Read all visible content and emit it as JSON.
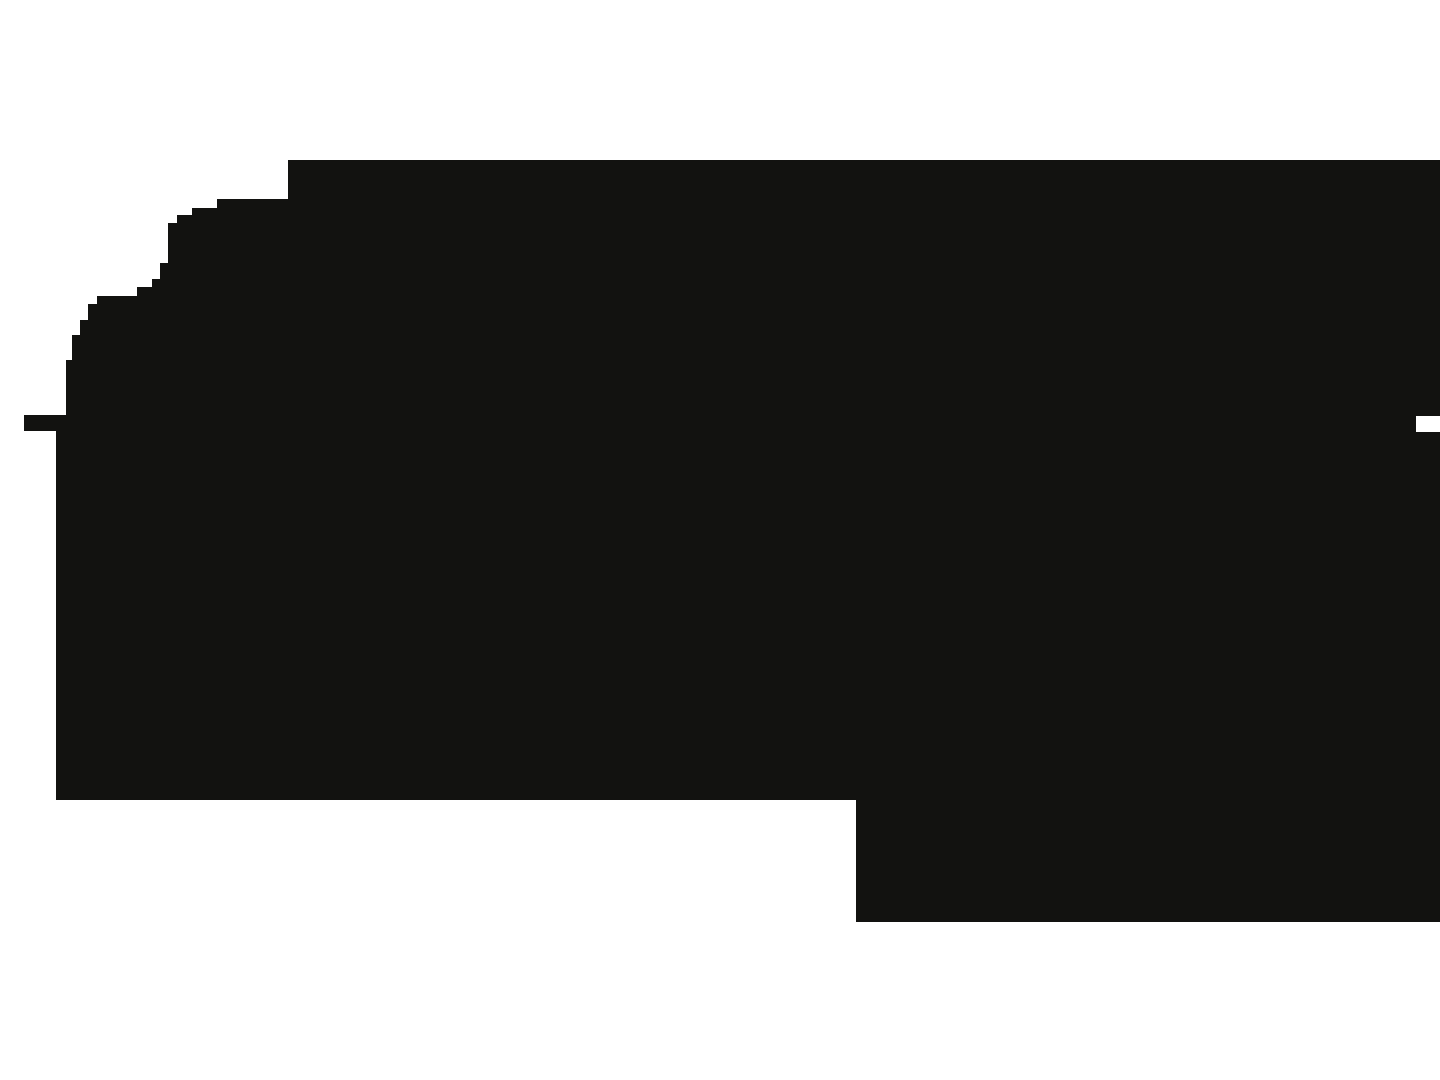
{
  "canvas": {
    "width": 1440,
    "height": 1080,
    "background_color": "#ffffff"
  },
  "silhouette": {
    "fill_color": "#121210",
    "points": [
      [
        288,
        160
      ],
      [
        1440,
        160
      ],
      [
        1440,
        416
      ],
      [
        1416,
        416
      ],
      [
        1416,
        432
      ],
      [
        1440,
        432
      ],
      [
        1440,
        922
      ],
      [
        856,
        922
      ],
      [
        856,
        800
      ],
      [
        56,
        800
      ],
      [
        56,
        431
      ],
      [
        24,
        431
      ],
      [
        24,
        415
      ],
      [
        66,
        415
      ],
      [
        66,
        360
      ],
      [
        72,
        360
      ],
      [
        72,
        335
      ],
      [
        80,
        335
      ],
      [
        80,
        320
      ],
      [
        88,
        320
      ],
      [
        88,
        304
      ],
      [
        97,
        304
      ],
      [
        97,
        296
      ],
      [
        137,
        296
      ],
      [
        137,
        287
      ],
      [
        152,
        287
      ],
      [
        152,
        279
      ],
      [
        160,
        279
      ],
      [
        160,
        263
      ],
      [
        168,
        263
      ],
      [
        168,
        223
      ],
      [
        177,
        223
      ],
      [
        177,
        215
      ],
      [
        192,
        215
      ],
      [
        192,
        208
      ],
      [
        217,
        208
      ],
      [
        217,
        199
      ],
      [
        288,
        199
      ]
    ]
  }
}
